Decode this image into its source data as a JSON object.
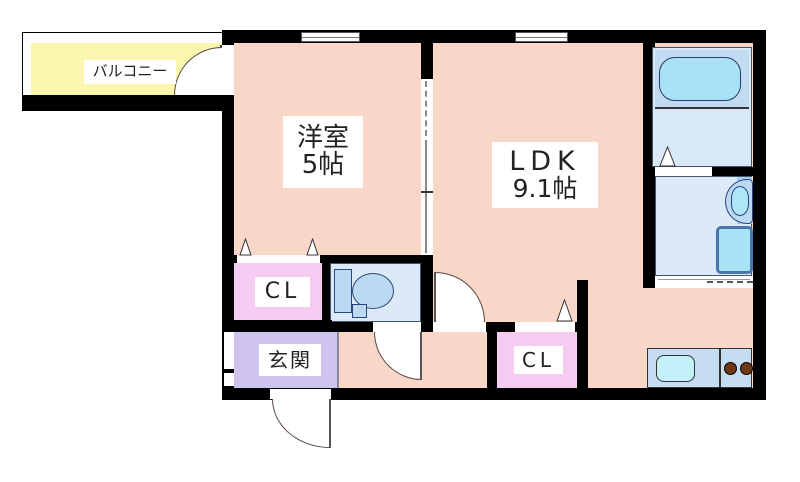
{
  "plan": {
    "balcony": {
      "label": "バルコニー"
    },
    "western_room": {
      "label": "洋室",
      "size": "5帖"
    },
    "ldk": {
      "label": "LDK",
      "size": "9.1帖"
    },
    "closet1": {
      "label": "CL"
    },
    "closet2": {
      "label": "CL"
    },
    "entrance": {
      "label": "玄関"
    }
  },
  "colors": {
    "wall": "#000000",
    "room_floor": "#F8D7C9",
    "closet_floor": "#F6CBF2",
    "entrance_floor": "#CFC3EF",
    "balcony_floor": "#FAF6AE",
    "wet_area_floor": "#DCE9F8",
    "tub_zone": "#C3DBF0",
    "bathtub": "#ABE1F5",
    "kitchen_counter": "#C6DCF2",
    "sink": "#C4F0FA",
    "burner": "#6F3812",
    "fixture": "#BBD9F0",
    "fixture_outline": "#27477A"
  }
}
